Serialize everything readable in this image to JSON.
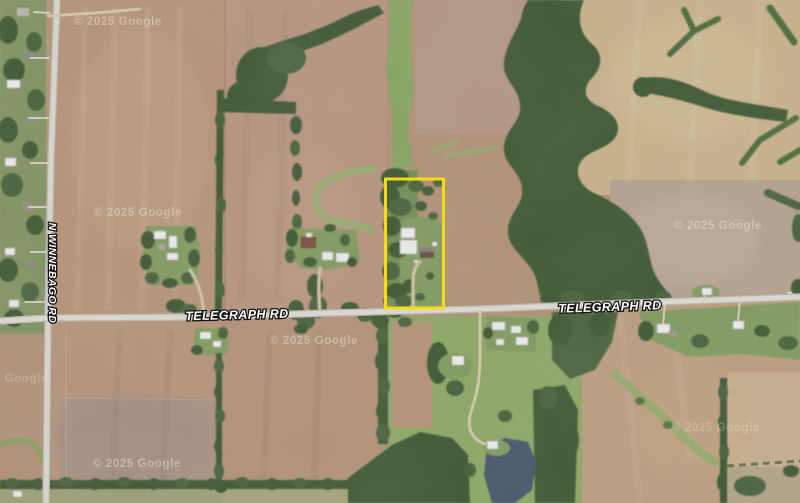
{
  "map": {
    "description": "Aerial satellite view of rural farmland with outlined property parcel",
    "roads": {
      "winnebago": {
        "label": "N WINNEBAGO RD",
        "orientation": "vertical"
      },
      "telegraph_west": {
        "label": "TELEGRAPH RD",
        "orientation": "horizontal"
      },
      "telegraph_east": {
        "label": "TELEGRAPH RD",
        "orientation": "horizontal"
      }
    },
    "attribution": {
      "text": "© 2025 Google"
    },
    "parcel": {
      "outline_color": "#F5E400"
    },
    "colors": {
      "field_tan": "#b29078",
      "pale_field": "#c8b28c",
      "woods_green": "#3b5630",
      "meadow_green": "#8ca766",
      "pond_blue": "#42526a",
      "road_gray": "#dcdbd4"
    }
  }
}
